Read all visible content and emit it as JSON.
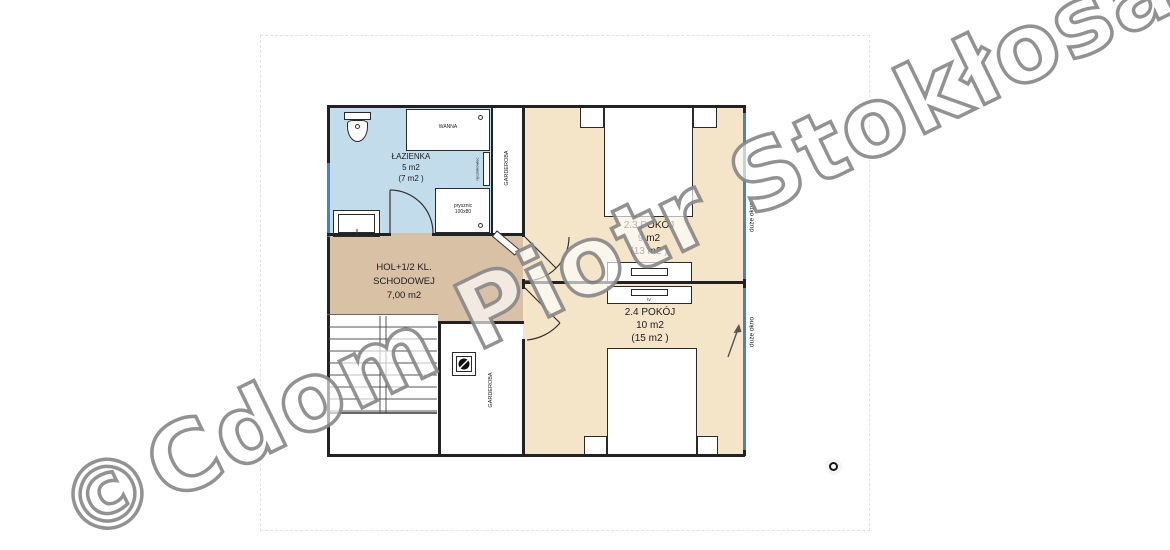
{
  "watermark": {
    "text": "©Cdom Piotr Stokłosa",
    "color": "#8a8a8a"
  },
  "plan": {
    "bathroom": {
      "name": "ŁAZIENKA",
      "area": "5 m2",
      "total": "(7 m2 )"
    },
    "hall": {
      "name_line1": "HOL+1/2 KL.",
      "name_line2": "SCHODOWEJ",
      "area": "7,00 m2"
    },
    "room_2_3": {
      "name": "2.3 POKÓJ",
      "area": "9 m2",
      "total": "(13 m2 )"
    },
    "room_2_4": {
      "name": "2.4 POKÓJ",
      "area": "10 m2",
      "total": "(15 m2 )"
    },
    "wardrobe_top": {
      "name": "GARDEROBA"
    },
    "wardrobe_bottom": {
      "name": "GARDEROBA"
    },
    "fixtures": {
      "bathtub": "WANNA",
      "shower": "prysznic",
      "shower_size": "100x80",
      "towel_radiator": "ręcznikowiec",
      "tv": "tv"
    },
    "windows": {
      "right_top": "duże okno",
      "right_bottom": "duże okno"
    }
  },
  "colors": {
    "bathroom_fill": "#c2dcec",
    "room_fill": "#f4e5c8",
    "hall_fill": "#d9c1a6",
    "window_blue": "#4187ba",
    "wall": "#222222",
    "watermark_gray": "#8a8a8a"
  }
}
